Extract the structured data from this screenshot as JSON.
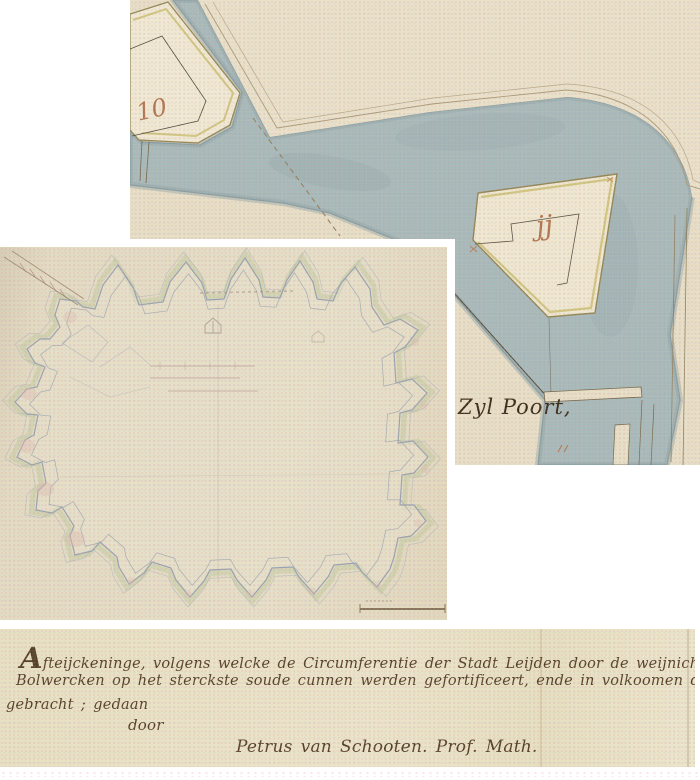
{
  "page": {
    "background": "#ffffff",
    "description": "Three scanned fragments of a 17th-century manuscript fortification map of Leiden"
  },
  "fragment_top": {
    "bastion_label": "10",
    "outwork_label": "jj",
    "gate_label": "Zyl Poort,",
    "colors": {
      "paper": "#e7dfca",
      "land": "#e9e1cd",
      "water": "#a6b9bd",
      "water_edge": "#7f98a0",
      "rampart_fill": "#f0e9d7",
      "rampart_edge": "#8f8454",
      "rampart_inner": "#cbc178",
      "number_ink": "#b0714e",
      "gate_ink": "#362718",
      "line_ink": "#6f6349"
    }
  },
  "fragment_plan": {
    "colors": {
      "paper": "#e4dcc8",
      "outline_blue": "#96a1b3",
      "glacis_green": "#bec9a2",
      "tint_pink": "#dcb9b2",
      "faint_ink": "#a09484"
    }
  },
  "fragment_caption": {
    "colors": {
      "paper": "#eae3cb",
      "ink": "#4f3b26"
    },
    "lines": {
      "l1": "Afteijckeninge, volgens welcke de Circumferentie der Stadt Leijden door de weijnichste",
      "l2": "Bolwercken op het sterckste soude cunnen werden gefortificeert, ende in volkoomen defensie",
      "l3": "gebracht ; gedaan",
      "l4": "door",
      "l5": "Petrus van Schooten. Prof. Math."
    }
  }
}
